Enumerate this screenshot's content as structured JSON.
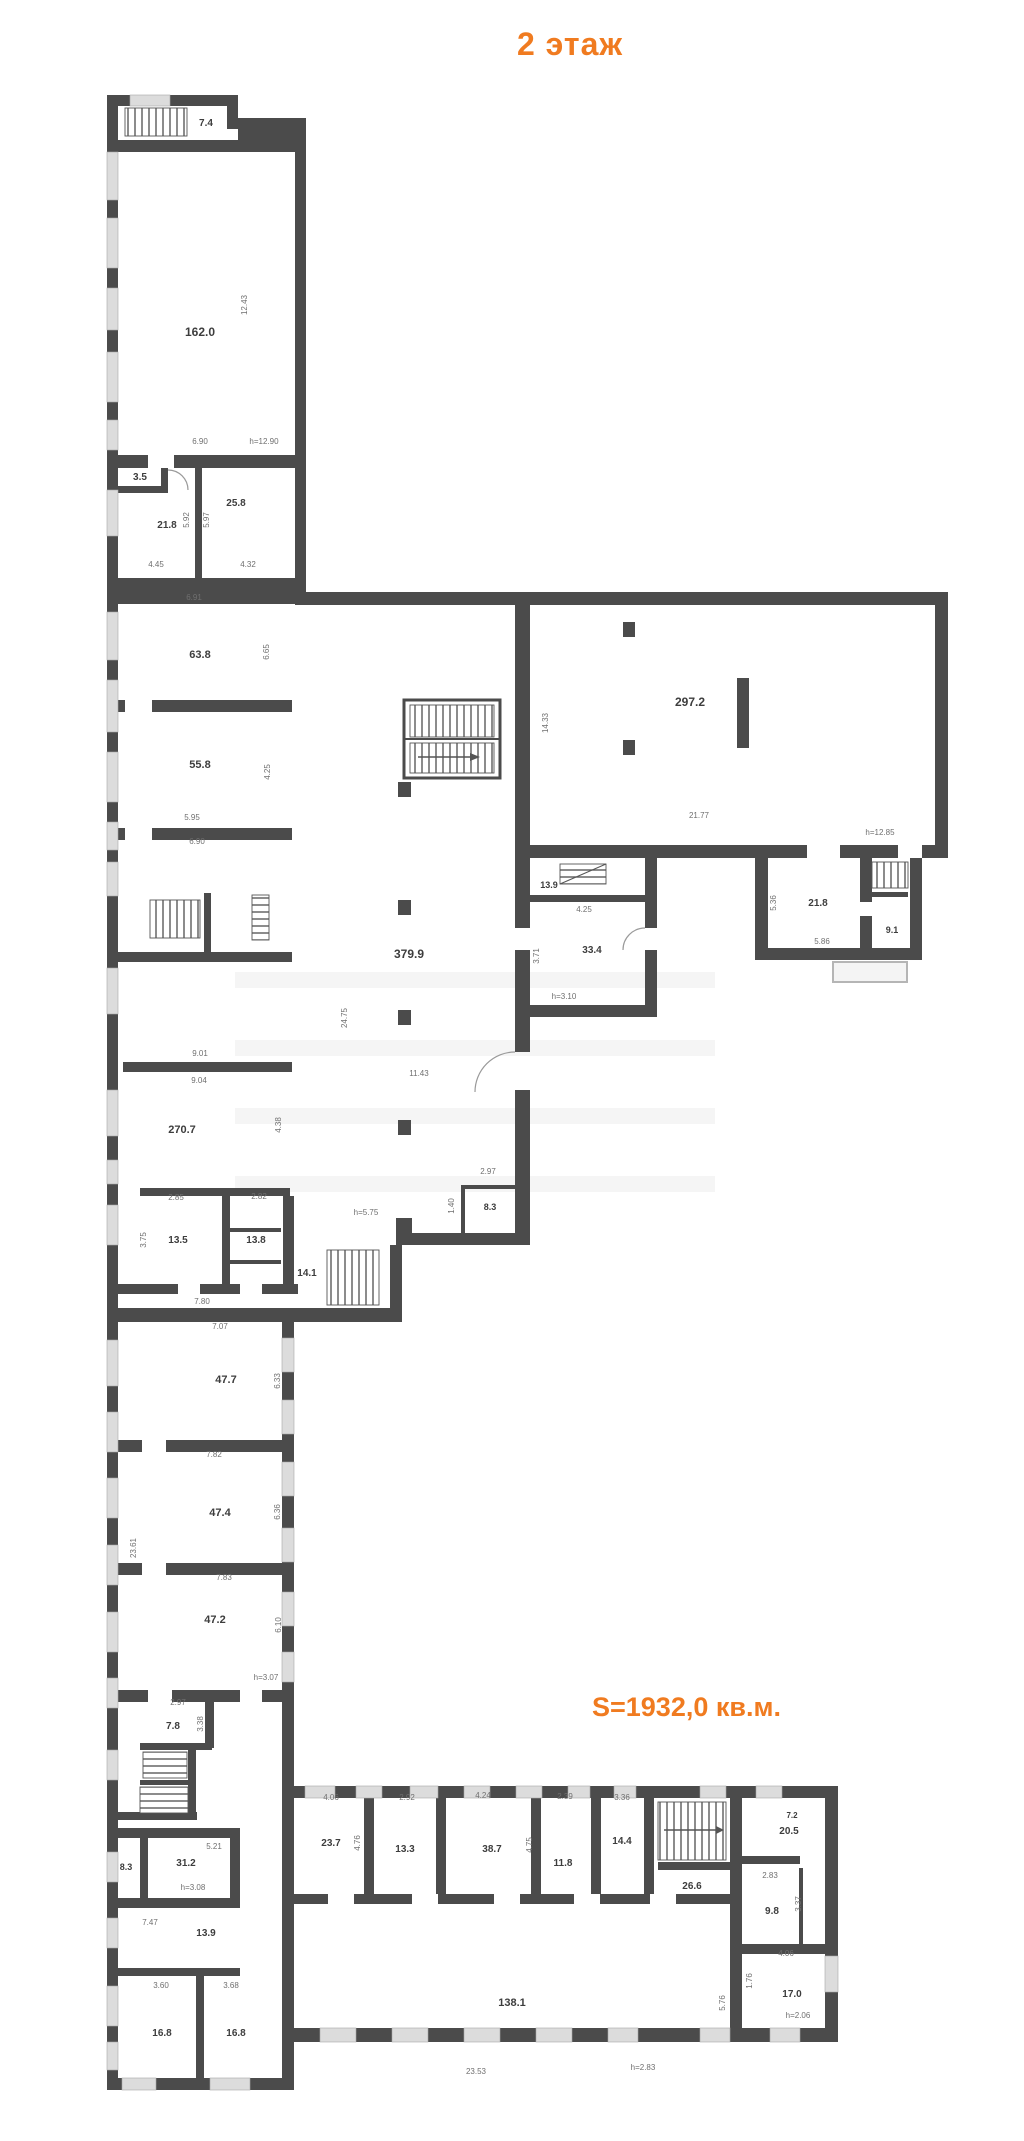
{
  "header": {
    "title": "2 этаж"
  },
  "summary": {
    "total_area": "S=1932,0 кв.м."
  },
  "colors": {
    "accent_orange": "#f07b20",
    "wall_gray": "#4b4b4b",
    "window_gray": "#dcdcdc",
    "room_label_gray": "#3d3d3d",
    "dim_label_gray": "#6f6f6f"
  },
  "plan": {
    "floor_number": "2",
    "room_area_labels": [
      {
        "text": "7.4",
        "x": 206,
        "y": 126,
        "size": 10
      },
      {
        "text": "162.0",
        "x": 200,
        "y": 336,
        "size": 12
      },
      {
        "text": "3.5",
        "x": 140,
        "y": 480,
        "size": 10
      },
      {
        "text": "21.8",
        "x": 167,
        "y": 528,
        "size": 10
      },
      {
        "text": "25.8",
        "x": 236,
        "y": 506,
        "size": 10
      },
      {
        "text": "63.8",
        "x": 200,
        "y": 658,
        "size": 11
      },
      {
        "text": "55.8",
        "x": 200,
        "y": 768,
        "size": 11
      },
      {
        "text": "270.7",
        "x": 182,
        "y": 1133,
        "size": 11
      },
      {
        "text": "13.5",
        "x": 178,
        "y": 1243,
        "size": 10
      },
      {
        "text": "13.8",
        "x": 256,
        "y": 1243,
        "size": 10
      },
      {
        "text": "14.1",
        "x": 307,
        "y": 1276,
        "size": 10
      },
      {
        "text": "47.7",
        "x": 226,
        "y": 1383,
        "size": 11
      },
      {
        "text": "47.4",
        "x": 220,
        "y": 1516,
        "size": 11
      },
      {
        "text": "47.2",
        "x": 215,
        "y": 1623,
        "size": 11
      },
      {
        "text": "7.8",
        "x": 173,
        "y": 1729,
        "size": 10
      },
      {
        "text": "8.3",
        "x": 126,
        "y": 1870,
        "size": 9
      },
      {
        "text": "31.2",
        "x": 186,
        "y": 1866,
        "size": 10
      },
      {
        "text": "13.9",
        "x": 206,
        "y": 1936,
        "size": 10
      },
      {
        "text": "16.8",
        "x": 162,
        "y": 2036,
        "size": 10
      },
      {
        "text": "16.8",
        "x": 236,
        "y": 2036,
        "size": 10
      },
      {
        "text": "379.9",
        "x": 409,
        "y": 958,
        "size": 12
      },
      {
        "text": "8.3",
        "x": 490,
        "y": 1210,
        "size": 9
      },
      {
        "text": "297.2",
        "x": 690,
        "y": 706,
        "size": 12
      },
      {
        "text": "13.9",
        "x": 549,
        "y": 888,
        "size": 9
      },
      {
        "text": "33.4",
        "x": 592,
        "y": 953,
        "size": 10
      },
      {
        "text": "21.8",
        "x": 818,
        "y": 906,
        "size": 10
      },
      {
        "text": "9.1",
        "x": 892,
        "y": 933,
        "size": 9
      },
      {
        "text": "23.7",
        "x": 331,
        "y": 1846,
        "size": 10
      },
      {
        "text": "13.3",
        "x": 405,
        "y": 1852,
        "size": 10
      },
      {
        "text": "38.7",
        "x": 492,
        "y": 1852,
        "size": 10
      },
      {
        "text": "11.8",
        "x": 563,
        "y": 1866,
        "size": 10
      },
      {
        "text": "14.4",
        "x": 622,
        "y": 1844,
        "size": 10
      },
      {
        "text": "26.6",
        "x": 692,
        "y": 1889,
        "size": 10
      },
      {
        "text": "7.2",
        "x": 792,
        "y": 1818,
        "size": 8
      },
      {
        "text": "20.5",
        "x": 789,
        "y": 1834,
        "size": 10
      },
      {
        "text": "9.8",
        "x": 772,
        "y": 1914,
        "size": 10
      },
      {
        "text": "17.0",
        "x": 792,
        "y": 1997,
        "size": 10
      },
      {
        "text": "138.1",
        "x": 512,
        "y": 2006,
        "size": 11
      }
    ],
    "dimension_labels": [
      {
        "text": "12.43",
        "x": 247,
        "y": 305,
        "rot": true
      },
      {
        "text": "6.90",
        "x": 200,
        "y": 444
      },
      {
        "text": "h=12.90",
        "x": 264,
        "y": 444
      },
      {
        "text": "4.45",
        "x": 156,
        "y": 567
      },
      {
        "text": "4.32",
        "x": 248,
        "y": 567
      },
      {
        "text": "5.92",
        "x": 189,
        "y": 520,
        "rot": true
      },
      {
        "text": "5.97",
        "x": 209,
        "y": 520,
        "rot": true
      },
      {
        "text": "6.91",
        "x": 194,
        "y": 600
      },
      {
        "text": "6.65",
        "x": 269,
        "y": 652,
        "rot": true
      },
      {
        "text": "4.25",
        "x": 270,
        "y": 772,
        "rot": true
      },
      {
        "text": "5.95",
        "x": 192,
        "y": 820
      },
      {
        "text": "6.90",
        "x": 197,
        "y": 844
      },
      {
        "text": "9.01",
        "x": 200,
        "y": 1056
      },
      {
        "text": "9.04",
        "x": 199,
        "y": 1083
      },
      {
        "text": "4.38",
        "x": 281,
        "y": 1125,
        "rot": true
      },
      {
        "text": "2.85",
        "x": 176,
        "y": 1200
      },
      {
        "text": "2.82",
        "x": 259,
        "y": 1199
      },
      {
        "text": "3.75",
        "x": 146,
        "y": 1240,
        "rot": true
      },
      {
        "text": "7.80",
        "x": 202,
        "y": 1304
      },
      {
        "text": "7.07",
        "x": 220,
        "y": 1329
      },
      {
        "text": "h=5.75",
        "x": 366,
        "y": 1215
      },
      {
        "text": "6.33",
        "x": 280,
        "y": 1381,
        "rot": true
      },
      {
        "text": "7.82",
        "x": 214,
        "y": 1457
      },
      {
        "text": "6.36",
        "x": 280,
        "y": 1512,
        "rot": true
      },
      {
        "text": "7.83",
        "x": 224,
        "y": 1580
      },
      {
        "text": "6.10",
        "x": 281,
        "y": 1625,
        "rot": true
      },
      {
        "text": "23.61",
        "x": 136,
        "y": 1548,
        "rot": true
      },
      {
        "text": "h=3.07",
        "x": 266,
        "y": 1680
      },
      {
        "text": "2.97",
        "x": 178,
        "y": 1705
      },
      {
        "text": "3.38",
        "x": 203,
        "y": 1724,
        "rot": true
      },
      {
        "text": "5.21",
        "x": 214,
        "y": 1849
      },
      {
        "text": "h=3.08",
        "x": 193,
        "y": 1890
      },
      {
        "text": "7.47",
        "x": 150,
        "y": 1925
      },
      {
        "text": "3.60",
        "x": 161,
        "y": 1988
      },
      {
        "text": "3.68",
        "x": 231,
        "y": 1988
      },
      {
        "text": "24.75",
        "x": 347,
        "y": 1018,
        "rot": true
      },
      {
        "text": "11.43",
        "x": 419,
        "y": 1076
      },
      {
        "text": "2.97",
        "x": 488,
        "y": 1174
      },
      {
        "text": "1.40",
        "x": 454,
        "y": 1206,
        "rot": true
      },
      {
        "text": "14.33",
        "x": 548,
        "y": 723,
        "rot": true
      },
      {
        "text": "21.77",
        "x": 699,
        "y": 818
      },
      {
        "text": "h=12.85",
        "x": 880,
        "y": 835
      },
      {
        "text": "4.25",
        "x": 584,
        "y": 912
      },
      {
        "text": "3.71",
        "x": 539,
        "y": 956,
        "rot": true
      },
      {
        "text": "h=3.10",
        "x": 564,
        "y": 999
      },
      {
        "text": "5.36",
        "x": 776,
        "y": 903,
        "rot": true
      },
      {
        "text": "5.86",
        "x": 822,
        "y": 944
      },
      {
        "text": "4.06",
        "x": 331,
        "y": 1800
      },
      {
        "text": "2.92",
        "x": 407,
        "y": 1800
      },
      {
        "text": "4.24",
        "x": 483,
        "y": 1798
      },
      {
        "text": "2.39",
        "x": 565,
        "y": 1799
      },
      {
        "text": "3.36",
        "x": 622,
        "y": 1800
      },
      {
        "text": "4.76",
        "x": 360,
        "y": 1843,
        "rot": true
      },
      {
        "text": "4.75",
        "x": 532,
        "y": 1845,
        "rot": true
      },
      {
        "text": "2.83",
        "x": 770,
        "y": 1878
      },
      {
        "text": "3.37",
        "x": 801,
        "y": 1904,
        "rot": true
      },
      {
        "text": "4.06",
        "x": 786,
        "y": 1956
      },
      {
        "text": "1.76",
        "x": 752,
        "y": 1981,
        "rot": true
      },
      {
        "text": "h=2.06",
        "x": 798,
        "y": 2018
      },
      {
        "text": "23.53",
        "x": 476,
        "y": 2074
      },
      {
        "text": "h=2.83",
        "x": 643,
        "y": 2070
      },
      {
        "text": "5.76",
        "x": 725,
        "y": 2003,
        "rot": true
      }
    ]
  }
}
